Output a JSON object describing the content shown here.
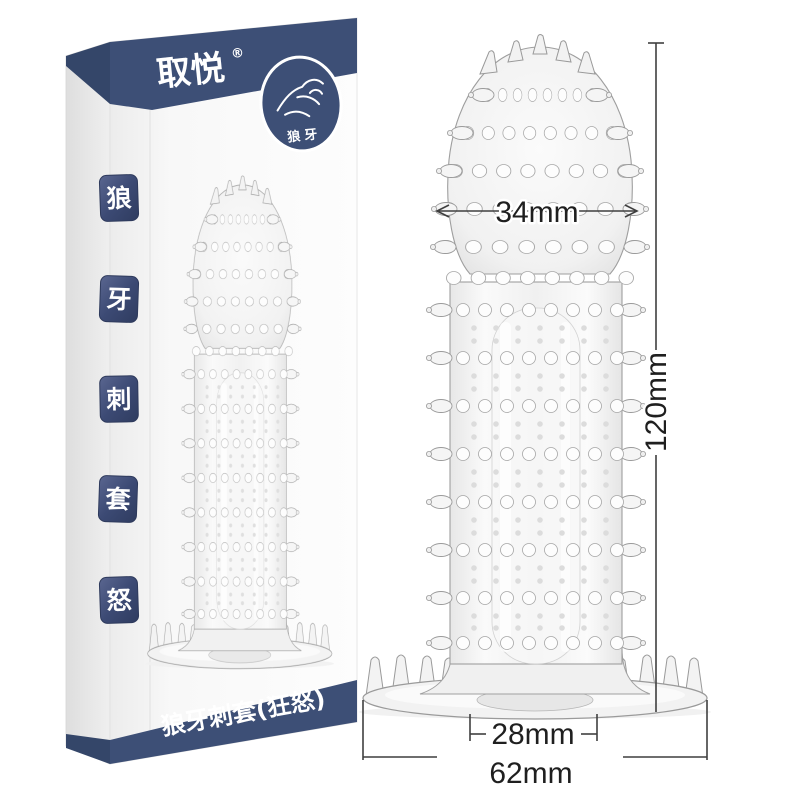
{
  "box": {
    "brand": "取悦",
    "trademark": "®",
    "logo_badge_text": "狼牙",
    "product_name": "狼牙刺套(狂怒)",
    "seals": [
      "狼",
      "牙",
      "刺",
      "套",
      "怒"
    ],
    "navy_color": "#3d4f76"
  },
  "dimensions": {
    "head_width": "34mm",
    "total_length": "120mm",
    "opening_width": "28mm",
    "base_width": "62mm"
  }
}
